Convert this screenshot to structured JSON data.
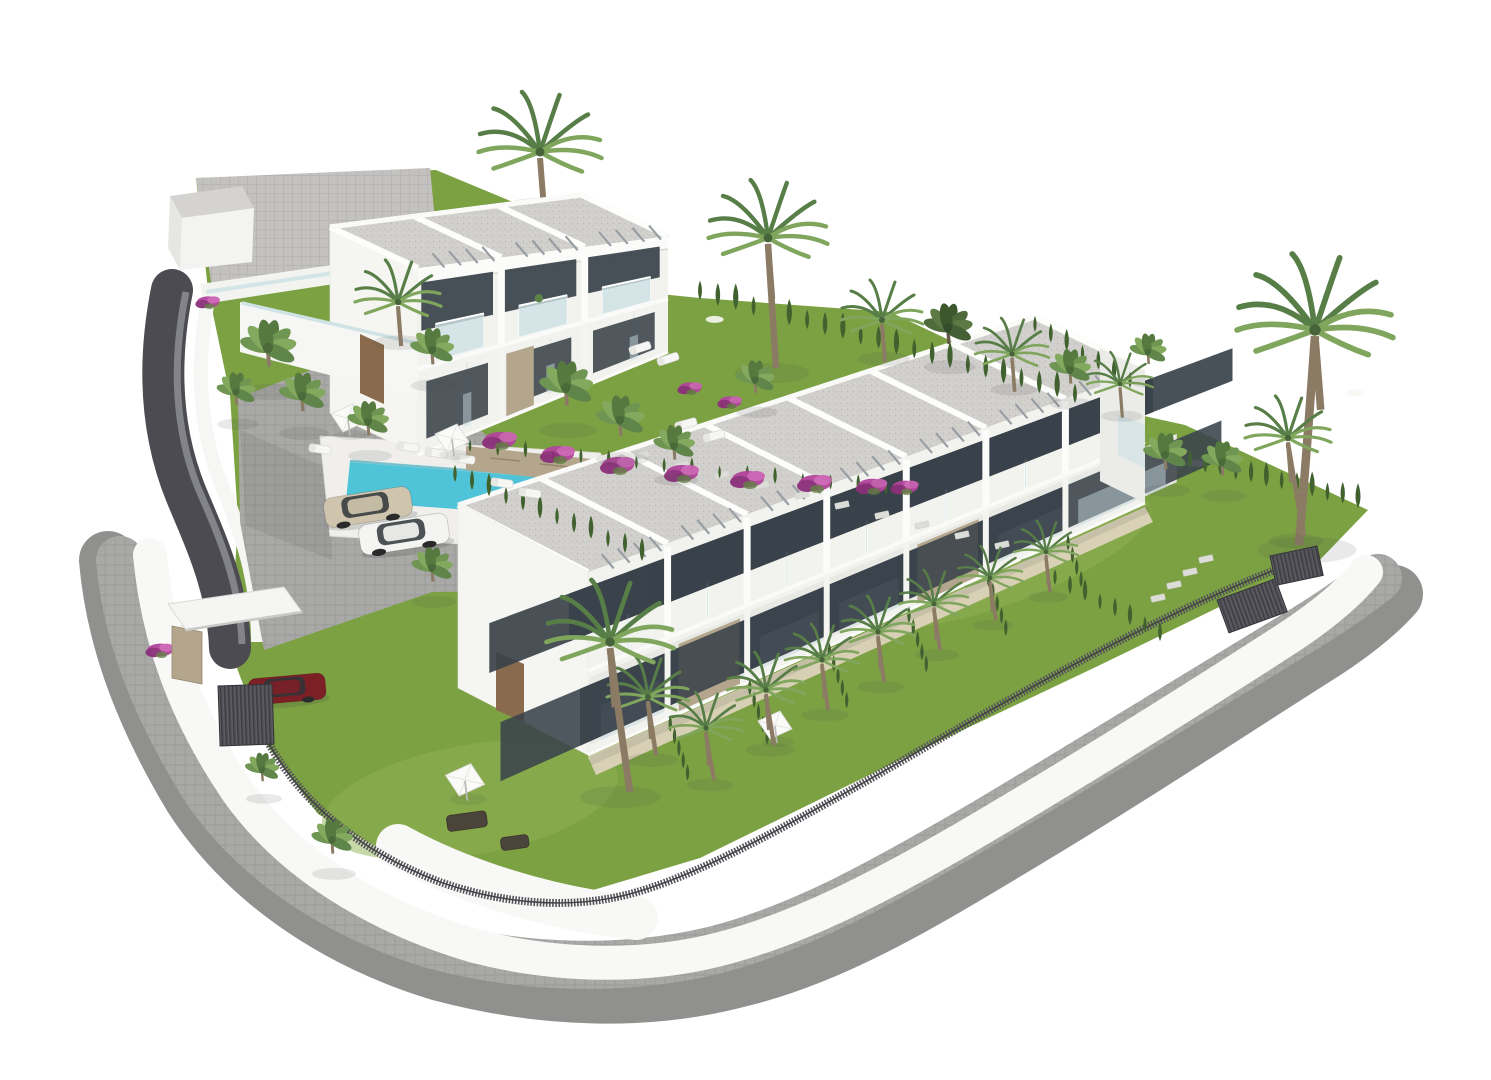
{
  "scene": {
    "type": "architectural-3d-render",
    "description": "Aerial CGI rendering of a white Mediterranean townhouse development on a white background: a long two-storey row of seven townhouses with grey gravel flat roofs, glass balconies and private gardens, a smaller two-storey block of three units behind, a turquoise swimming pool with sun loungers and parasols, parking with three cars, palm trees, cypress hedges, bougainvillea, dark slatted fences and a curved grey paved perimeter road with white boundary walls",
    "background": "#ffffff"
  },
  "palette": {
    "bg": "#ffffff",
    "grass": "#7ca143",
    "grassDark": "#69923a",
    "grassLight": "#8fb254",
    "wall": "#f3f3f0",
    "wallShade": "#e7e7e4",
    "fascia": "#fbfbfa",
    "glass": "#cfe3e6",
    "opening": "#39424a",
    "sand": "#ddd3bc",
    "stone": "#b3a68c",
    "stoneDark": "#97876c",
    "deck": "#f0efec",
    "pool": "#4fc3d8",
    "poolLight": "#8fdfeb",
    "roofGravel": "#d1d0cd",
    "roofDot": "#bbbab7",
    "cobble": "#a8a8a6",
    "cobbleLine": "#9a9a98",
    "promenade": "#bab9b7",
    "ramp": "#4b4b51",
    "rampLight": "#83838a",
    "fence": "#54545a",
    "gate": "#45454c",
    "pergola": "#989fa4",
    "cypress": "#41622f",
    "palmLight": "#7fa65c",
    "palmDeep": "#587e48",
    "trunk": "#8c7b64",
    "door": "#8a6a4d",
    "bougainvillea": "#b2449b",
    "bougainvilleaDark": "#8c2f7a",
    "bougainvilleaLight": "#cb62b4",
    "carBeige": "#cfc4ad",
    "carWhite": "#f4f4f2",
    "carRed": "#7c2026",
    "shadow": "rgba(70,70,70,0.12)"
  },
  "objects": {
    "building_blocks": 2,
    "front_row_units": 7,
    "back_block_units": 3,
    "storeys": 2,
    "swimming_pool": 1,
    "cars": 3,
    "palm_trees": 34,
    "sun_loungers": 10,
    "parasols": 4,
    "entrance_gates": 3,
    "boundary": "curved paved road, white walls, dark slatted fence"
  },
  "placements": {
    "palms_behind": [
      {
        "x": 540,
        "y": 152,
        "s": 1.5,
        "v": "f"
      }
    ],
    "palms": [
      {
        "x": 768,
        "y": 238,
        "s": 1.45,
        "v": "f",
        "t": 130,
        "dx": 4
      },
      {
        "x": 268,
        "y": 348,
        "s": 1.15,
        "v": "b"
      },
      {
        "x": 236,
        "y": 392,
        "s": 0.8,
        "v": "b"
      },
      {
        "x": 302,
        "y": 396,
        "s": 0.95,
        "v": "b"
      },
      {
        "x": 398,
        "y": 302,
        "s": 1.05,
        "v": "f"
      },
      {
        "x": 432,
        "y": 350,
        "s": 0.9,
        "v": "b"
      },
      {
        "x": 368,
        "y": 422,
        "s": 0.85,
        "v": "b"
      },
      {
        "x": 566,
        "y": 388,
        "s": 1.1,
        "v": "b"
      },
      {
        "x": 620,
        "y": 420,
        "s": 1.0,
        "v": "b"
      },
      {
        "x": 674,
        "y": 446,
        "s": 0.85,
        "v": "b"
      },
      {
        "x": 755,
        "y": 380,
        "s": 0.8,
        "v": "b"
      },
      {
        "x": 882,
        "y": 320,
        "s": 1.0,
        "v": "f"
      },
      {
        "x": 948,
        "y": 328,
        "s": 1.0,
        "v": "b",
        "d": true
      },
      {
        "x": 1012,
        "y": 354,
        "s": 0.9,
        "v": "f"
      },
      {
        "x": 1070,
        "y": 370,
        "s": 0.85,
        "v": "b"
      },
      {
        "x": 1120,
        "y": 384,
        "s": 0.8,
        "v": "f"
      },
      {
        "x": 1148,
        "y": 352,
        "s": 0.75,
        "v": "b"
      },
      {
        "x": 1315,
        "y": 330,
        "s": 1.9,
        "v": "f",
        "t": 215,
        "dx": -8
      },
      {
        "x": 1288,
        "y": 438,
        "s": 1.05,
        "v": "f",
        "t": 98,
        "dx": 8
      },
      {
        "x": 1165,
        "y": 455,
        "s": 0.9,
        "v": "b"
      },
      {
        "x": 1222,
        "y": 462,
        "s": 0.85,
        "v": "b"
      },
      {
        "x": 648,
        "y": 697,
        "s": 1.0,
        "v": "f",
        "t": 58,
        "dx": 4
      },
      {
        "x": 706,
        "y": 728,
        "s": 0.9,
        "v": "f",
        "t": 52,
        "dx": 4
      },
      {
        "x": 766,
        "y": 690,
        "s": 0.95,
        "v": "f",
        "t": 55,
        "dx": 4
      },
      {
        "x": 822,
        "y": 660,
        "s": 0.9,
        "v": "f",
        "t": 50,
        "dx": 3
      },
      {
        "x": 878,
        "y": 632,
        "s": 0.9,
        "v": "f",
        "t": 50,
        "dx": 3
      },
      {
        "x": 934,
        "y": 604,
        "s": 0.85,
        "v": "f",
        "t": 46,
        "dx": 3
      },
      {
        "x": 990,
        "y": 578,
        "s": 0.8,
        "v": "f",
        "t": 42,
        "dx": 3
      },
      {
        "x": 1046,
        "y": 552,
        "s": 0.78,
        "v": "f",
        "t": 40,
        "dx": 2
      },
      {
        "x": 610,
        "y": 642,
        "s": 1.55,
        "v": "f",
        "t": 150,
        "dx": 10
      },
      {
        "x": 332,
        "y": 840,
        "s": 0.85,
        "v": "b"
      },
      {
        "x": 262,
        "y": 770,
        "s": 0.7,
        "v": "b"
      },
      {
        "x": 432,
        "y": 568,
        "s": 0.85,
        "v": "b"
      }
    ],
    "hedges": [
      {
        "x1": 455,
        "y1": 482,
        "x2": 642,
        "y2": 560,
        "n": 12,
        "s": 0.75
      },
      {
        "x1": 470,
        "y1": 452,
        "x2": 886,
        "y2": 494,
        "n": 16,
        "s": 0.55
      },
      {
        "x1": 700,
        "y1": 300,
        "x2": 1075,
        "y2": 402,
        "n": 22,
        "s": 0.85
      },
      {
        "x1": 1035,
        "y1": 332,
        "x2": 1130,
        "y2": 388,
        "n": 7,
        "s": 0.7
      },
      {
        "x1": 1190,
        "y1": 468,
        "x2": 1358,
        "y2": 507,
        "n": 12,
        "s": 0.8
      },
      {
        "x1": 1055,
        "y1": 585,
        "x2": 1160,
        "y2": 640,
        "n": 8,
        "s": 0.7
      },
      {
        "x1": 178,
        "y1": 650,
        "x2": 190,
        "y2": 654,
        "n": 2,
        "s": 1.0
      }
    ],
    "loungers": [
      {
        "x": 408,
        "y": 447,
        "r": 8
      },
      {
        "x": 436,
        "y": 453,
        "r": 8
      },
      {
        "x": 464,
        "y": 459,
        "r": 8
      },
      {
        "x": 502,
        "y": 483,
        "r": 8
      },
      {
        "x": 530,
        "y": 493,
        "r": 8
      },
      {
        "x": 320,
        "y": 449,
        "r": 8
      },
      {
        "x": 640,
        "y": 348,
        "r": -18
      },
      {
        "x": 668,
        "y": 359,
        "r": -18
      },
      {
        "x": 686,
        "y": 424,
        "r": -15
      },
      {
        "x": 714,
        "y": 436,
        "r": -15
      }
    ],
    "umbrellas": [
      {
        "x": 348,
        "y": 419,
        "s": 1
      },
      {
        "x": 452,
        "y": 439,
        "s": 1
      },
      {
        "x": 465,
        "y": 781,
        "s": 1.15
      },
      {
        "x": 775,
        "y": 726,
        "s": 1
      }
    ],
    "stones": [
      {
        "x": 642,
        "y": 455
      },
      {
        "x": 682,
        "y": 465
      },
      {
        "x": 722,
        "y": 475
      },
      {
        "x": 762,
        "y": 485
      },
      {
        "x": 802,
        "y": 495
      },
      {
        "x": 842,
        "y": 505
      },
      {
        "x": 882,
        "y": 515
      },
      {
        "x": 922,
        "y": 525
      },
      {
        "x": 962,
        "y": 535
      },
      {
        "x": 1002,
        "y": 545
      },
      {
        "x": 1158,
        "y": 598
      },
      {
        "x": 1174,
        "y": 585
      },
      {
        "x": 1190,
        "y": 572
      },
      {
        "x": 1206,
        "y": 559
      }
    ],
    "bougainvillea": [
      {
        "x": 500,
        "y": 440,
        "s": 1
      },
      {
        "x": 558,
        "y": 454,
        "s": 1
      },
      {
        "x": 618,
        "y": 465,
        "s": 1
      },
      {
        "x": 682,
        "y": 473,
        "s": 1
      },
      {
        "x": 748,
        "y": 479,
        "s": 1
      },
      {
        "x": 815,
        "y": 483,
        "s": 1
      },
      {
        "x": 872,
        "y": 486,
        "s": 0.9
      },
      {
        "x": 905,
        "y": 487,
        "s": 0.8
      },
      {
        "x": 690,
        "y": 388,
        "s": 0.7
      },
      {
        "x": 730,
        "y": 402,
        "s": 0.7
      },
      {
        "x": 160,
        "y": 650,
        "s": 0.8
      },
      {
        "x": 208,
        "y": 302,
        "s": 0.7
      }
    ],
    "cars": [
      {
        "x": 368,
        "y": 507,
        "r": -9,
        "s": 1.0,
        "color": "#cfc4ad",
        "kind": "sedan"
      },
      {
        "x": 404,
        "y": 534,
        "r": -9,
        "s": 1.02,
        "color": "#f4f4f2",
        "kind": "coupe"
      },
      {
        "x": 287,
        "y": 689,
        "r": -5,
        "s": 0.88,
        "color": "#7c2026",
        "kind": "suv"
      }
    ],
    "gates": [
      {
        "x": 218,
        "y": 686,
        "w": 54,
        "h": 60,
        "r": -2
      },
      {
        "x": 1217,
        "y": 600,
        "w": 62,
        "h": 35,
        "r": -20
      },
      {
        "x": 1270,
        "y": 556,
        "w": 48,
        "h": 30,
        "r": -12
      }
    ],
    "sofas": [
      {
        "x": 446,
        "y": 816,
        "w": 40,
        "h": 16,
        "r": -8
      },
      {
        "x": 500,
        "y": 838,
        "w": 28,
        "h": 13,
        "r": -8
      }
    ]
  }
}
